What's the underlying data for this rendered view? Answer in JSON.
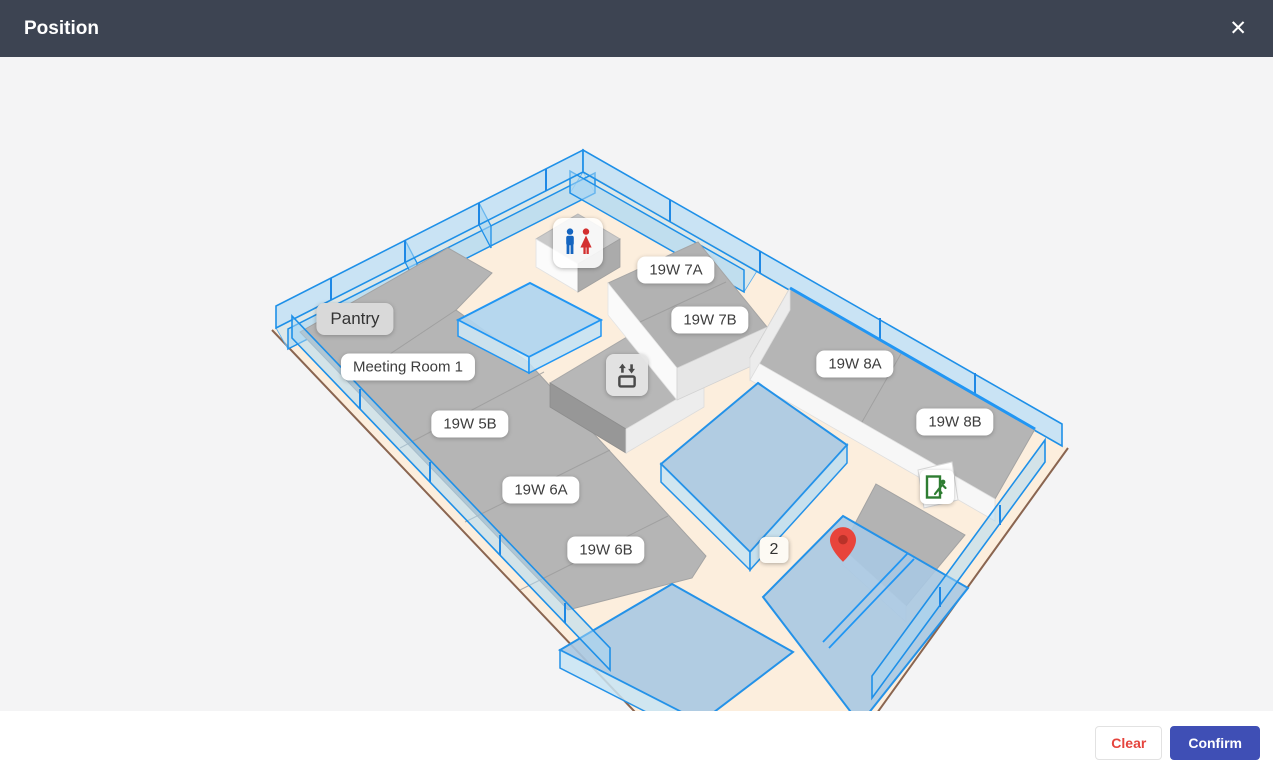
{
  "modal": {
    "title": "Position",
    "close_icon": "✕"
  },
  "map": {
    "room_labels": [
      {
        "text": "Pantry"
      },
      {
        "text": "Meeting Room 1"
      },
      {
        "text": "19W 5B"
      },
      {
        "text": "19W 6A"
      },
      {
        "text": "19W 6B"
      },
      {
        "text": "19W 7A"
      },
      {
        "text": "19W 7B"
      },
      {
        "text": "19W 8A"
      },
      {
        "text": "19W 8B"
      }
    ],
    "floor_marker": "2",
    "icons": [
      {
        "name": "restroom-icon"
      },
      {
        "name": "elevator-icon"
      },
      {
        "name": "emergency-exit-icon"
      },
      {
        "name": "location-pin-icon"
      }
    ],
    "colors": {
      "floor_beige": "#fceedd",
      "room_gray": "#b5b5b5",
      "glass_stroke_blue": "#2196f3",
      "glass_top_fill": "#a9c8e4",
      "pin_red": "#e8443b",
      "restroom_man_blue": "#1565c0",
      "restroom_woman_red": "#d32f2f",
      "exit_green": "#2e7d32"
    }
  },
  "footer": {
    "clear_label": "Clear",
    "confirm_label": "Confirm"
  },
  "theme": {
    "header_bg": "#3d4452",
    "confirm_bg": "#3f4fb5",
    "clear_text": "#e5443d"
  }
}
